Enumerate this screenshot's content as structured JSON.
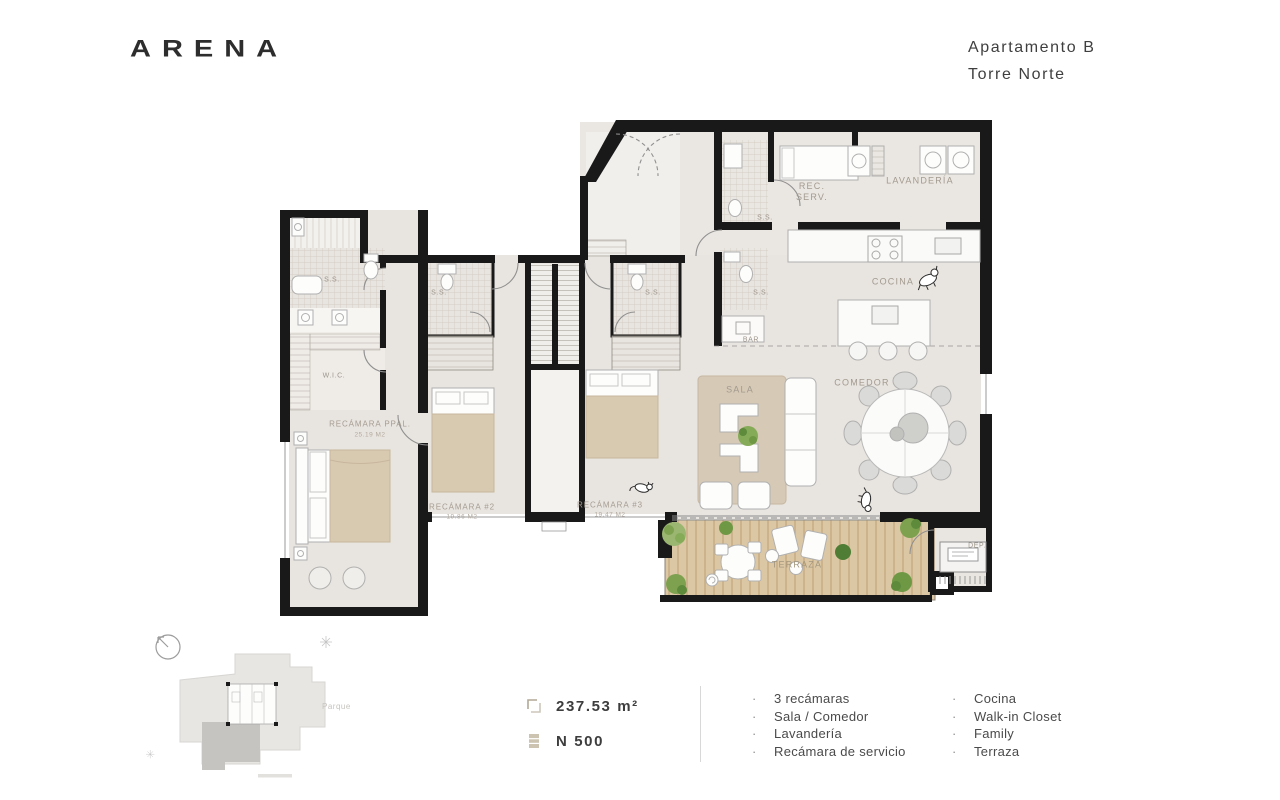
{
  "brand": {
    "logo_text": "ARENA"
  },
  "header": {
    "apartment": "Apartamento B",
    "tower": "Torre Norte"
  },
  "plan": {
    "labels": {
      "rec_serv": "REC.\nSERV.",
      "lavanderia": "LAVANDERÍA",
      "ss": "S.S.",
      "bar": "BAR",
      "cocina": "COCINA",
      "sala": "SALA",
      "comedor": "COMEDOR",
      "terraza": "TERRAZA",
      "dep": "DEP.",
      "wic": "W.I.C.",
      "recamara_ppal": "RECÁMARA PPAL.",
      "recamara_ppal_area": "25.19 M2",
      "recamara_2": "RECÁMARA #2",
      "recamara_2_area": "19.86 M2",
      "recamara_3": "RECÁMARA #3",
      "recamara_3_area": "19.47 M2"
    }
  },
  "keyplan": {
    "parque_label": "Parque"
  },
  "footer": {
    "area_value": "237.53 m²",
    "unit_value": "N 500",
    "features_left": [
      "3 recámaras",
      "Sala / Comedor",
      "Lavandería",
      "Recámara de servicio"
    ],
    "features_right": [
      "Cocina",
      "Walk-in Closet",
      "Family",
      "Terraza"
    ]
  }
}
